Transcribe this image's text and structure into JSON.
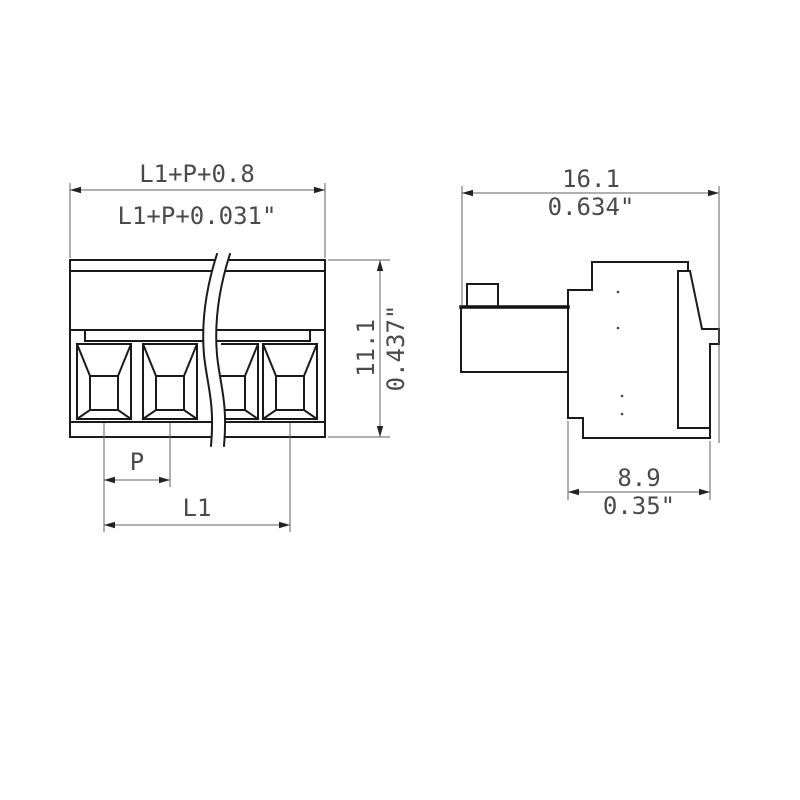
{
  "drawing": {
    "front_view": {
      "overall_width_mm": "L1+P+0.8",
      "overall_width_inch": "L1+P+0.031\"",
      "height_mm": "11.1",
      "height_inch": "0.437\"",
      "pitch_label": "P",
      "length_label": "L1"
    },
    "side_view": {
      "width_mm": "16.1",
      "width_inch": "0.634\"",
      "depth_mm": "8.9",
      "depth_inch": "0.35\""
    },
    "colors": {
      "object_line": "#1a1a1a",
      "dimension_line": "#606060",
      "text": "#4a4a4a",
      "background": "#ffffff"
    }
  }
}
